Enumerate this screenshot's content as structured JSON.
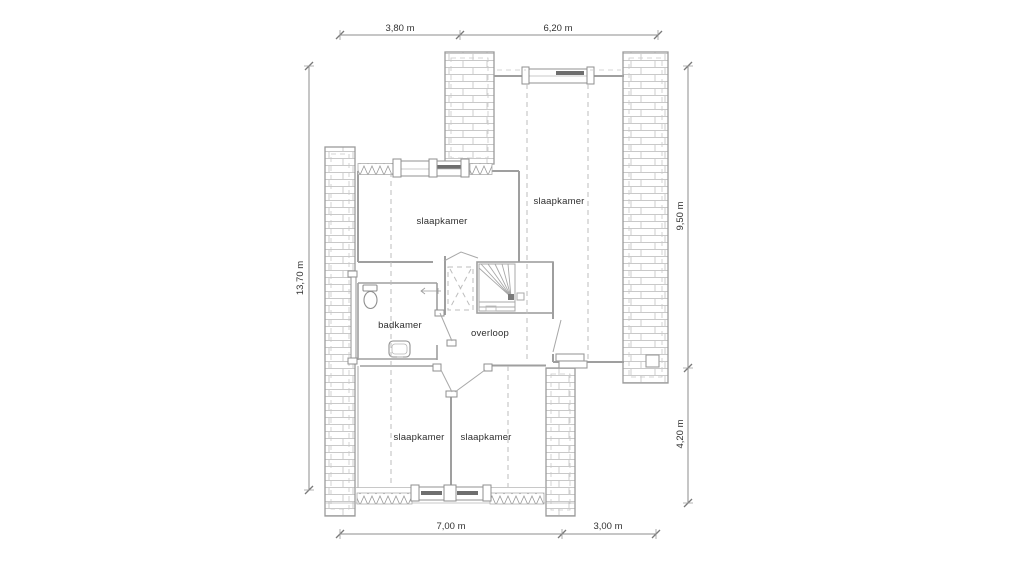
{
  "drawing": {
    "type": "floor-plan",
    "language": "nl",
    "floor": "verdieping"
  },
  "colors": {
    "background": "#ffffff",
    "wall_line": "#9f9f9f",
    "hatch_line": "#c9c9c9",
    "dark_sash": "#6e6e6e",
    "dashed_line": "#bdbdbd",
    "dimension_line": "#8e8e8e",
    "text": "#2e2e2e"
  },
  "rooms": [
    {
      "id": "bedroom-top-left",
      "label": "slaapkamer"
    },
    {
      "id": "bedroom-top-right",
      "label": "slaapkamer"
    },
    {
      "id": "bathroom",
      "label": "badkamer"
    },
    {
      "id": "landing",
      "label": "overloop"
    },
    {
      "id": "bedroom-bottom-left",
      "label": "slaapkamer"
    },
    {
      "id": "bedroom-bottom-middle",
      "label": "slaapkamer"
    }
  ],
  "dims": {
    "top": [
      {
        "label": "3,80 m"
      },
      {
        "label": "6,20 m"
      }
    ],
    "bottom": [
      {
        "label": "7,00 m"
      },
      {
        "label": "3,00 m"
      }
    ],
    "left": [
      {
        "label": "13,70 m"
      }
    ],
    "right": [
      {
        "label": "9,50 m"
      },
      {
        "label": "4,20 m"
      }
    ]
  }
}
